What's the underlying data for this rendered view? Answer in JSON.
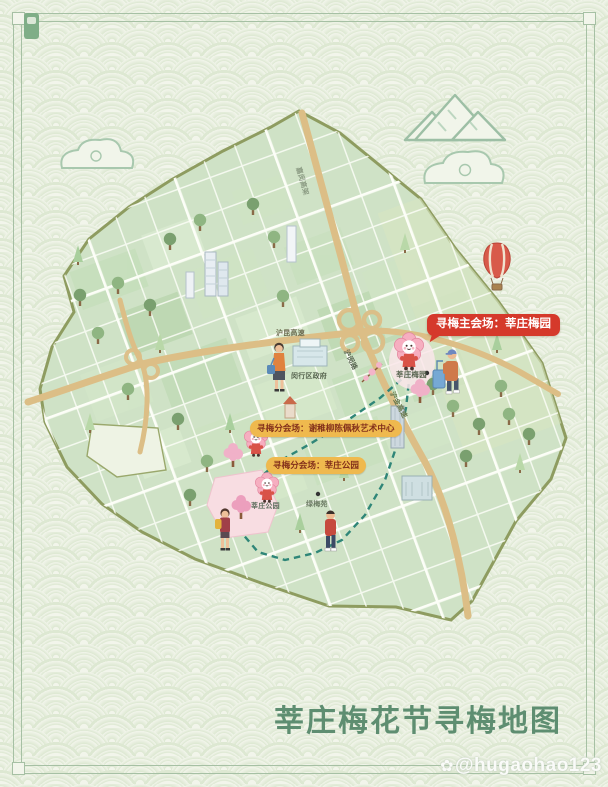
{
  "poster": {
    "title": "莘庄梅花节寻梅地图",
    "watermark": {
      "icon": "✿",
      "text": "@hugaohao123"
    }
  },
  "venues": {
    "main": "寻梅主会场：莘庄梅园",
    "sub1": "寻梅分会场：谢稚柳陈佩秋艺术中心",
    "sub2": "寻梅分会场：莘庄公园"
  },
  "map_labels": {
    "hukun_expressway": "沪昆高速",
    "jiamin_elevated": "嘉闵高架",
    "humin_road": "沪闵路",
    "hujin_expressway": "沪金高速",
    "minhang_government": "闵行区政府",
    "xinzhuang_meiyuan": "莘庄梅园",
    "xinzhuang_park": "莘庄公园",
    "lvmei_yuan": "绿梅苑"
  },
  "colors": {
    "background": "#f2f5eb",
    "pattern_line": "#dde8d2",
    "frame": "#a6c0a4",
    "land": "#cfe2c6",
    "boundary": "#8e9c60",
    "highway": "#dcbe86",
    "route_dash": "#2f8678",
    "main_label_bg": "#d5392b",
    "sub_label_bg": "#efb94e",
    "sub_label_text": "#83301b",
    "title_green": "#5e8e71",
    "mascot_pink": "#f6aec0"
  }
}
